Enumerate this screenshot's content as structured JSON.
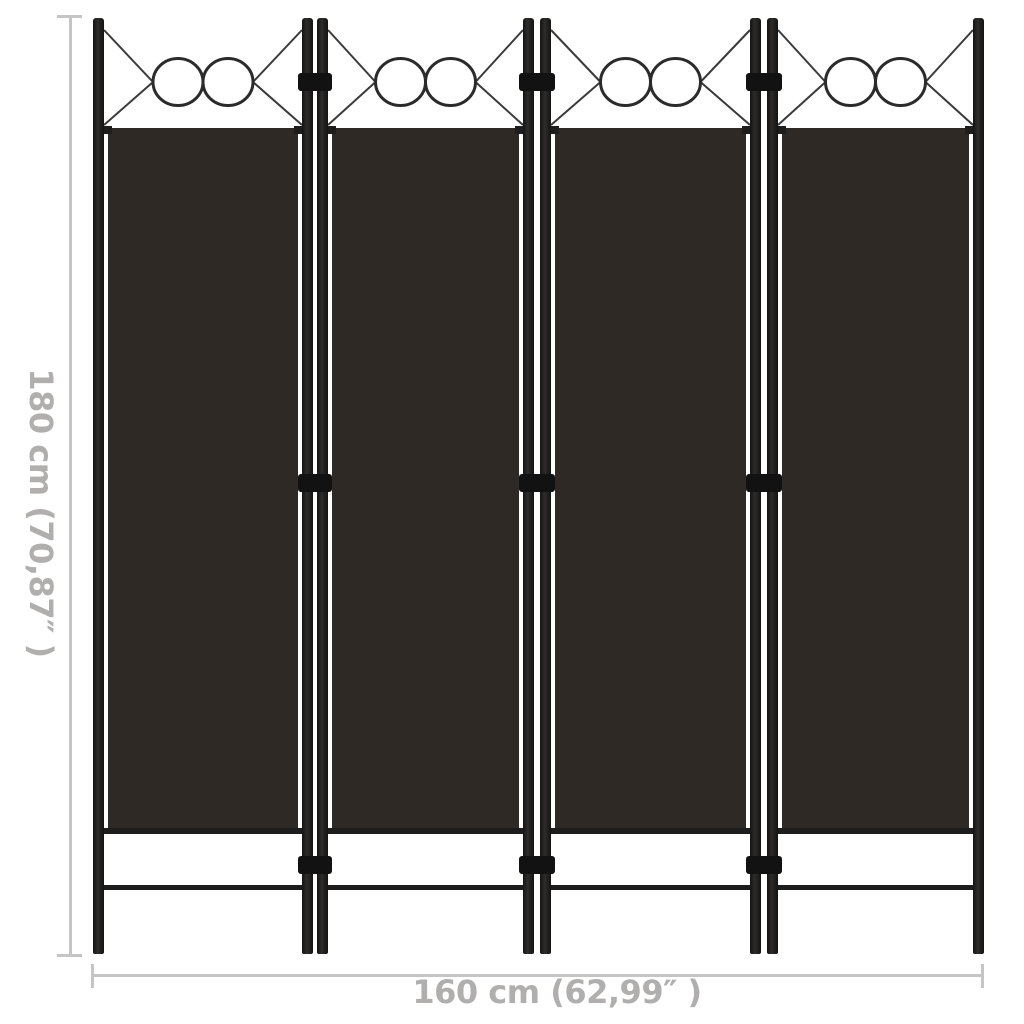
{
  "product_diagram": {
    "panel_count": 4,
    "decor_circles_per_panel": 2,
    "hinge_rows": 3
  },
  "dimensions": {
    "height_label": "180 cm (70,87″ )",
    "width_label": "160 cm (62,99″ )"
  },
  "colors": {
    "background": "#ffffff",
    "fabric": "#2e2925",
    "frame": "#1e1d1d",
    "hinge": "#131212",
    "decor_line": "#3a3a3a",
    "circle_stroke": "#2b2b2b",
    "dim_line": "#c5c5c5",
    "dim_text": "#b1aeae"
  }
}
